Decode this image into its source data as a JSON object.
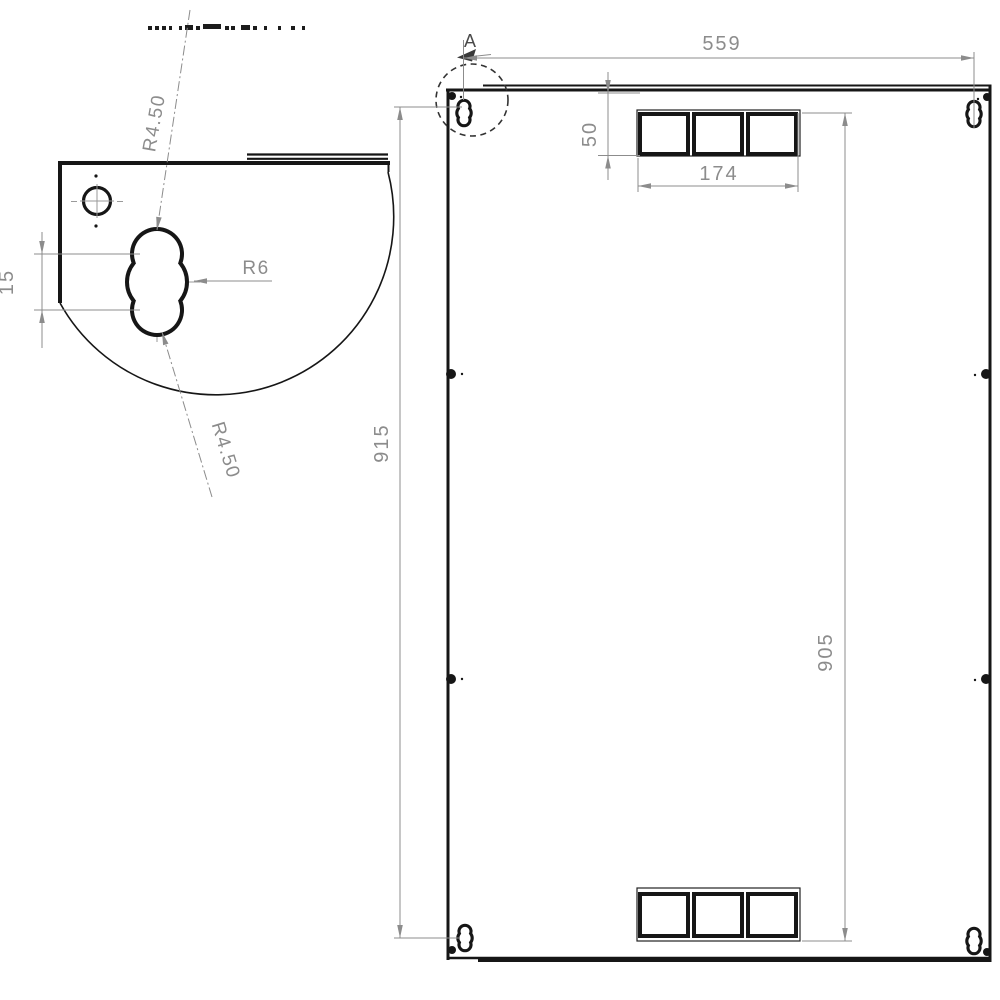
{
  "drawing": {
    "cropped_header": {
      "note": "partially-cropped text fragments at top edge"
    },
    "detail_view": {
      "radius_top_label": "R4.50",
      "radius_bottom_label": "R4.50",
      "radius_middle_label": "R6",
      "slot_spacing_label": "15"
    },
    "panel_view": {
      "detail_marker_label": "A",
      "width_label": "559",
      "height_left_label": "915",
      "height_right_label": "905",
      "slot_height_label": "50",
      "slot_group_width_label": "174"
    },
    "colors": {
      "line": "#161616",
      "dimension": "#8c8c8c",
      "background": "#ffffff"
    }
  }
}
